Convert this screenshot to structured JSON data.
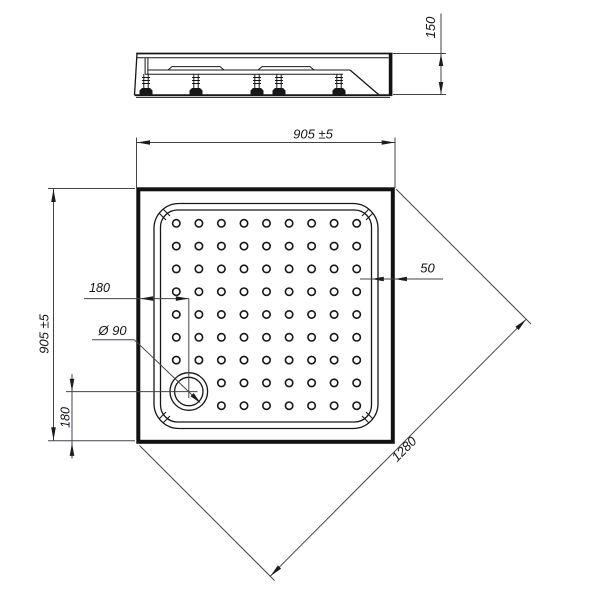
{
  "labels": {
    "height": "150",
    "width": "905 ±5",
    "depth": "905 ±5",
    "rim_width": "50",
    "drain_offset_x": "180",
    "drain_offset_y": "180",
    "drain_diameter": "Ø 90",
    "diagonal": "1280"
  },
  "dot_grid": {
    "rows": 9,
    "cols": 9
  },
  "colors": {
    "line": "#17171a",
    "dim_line": "#46424c",
    "background": "#ffffff"
  }
}
